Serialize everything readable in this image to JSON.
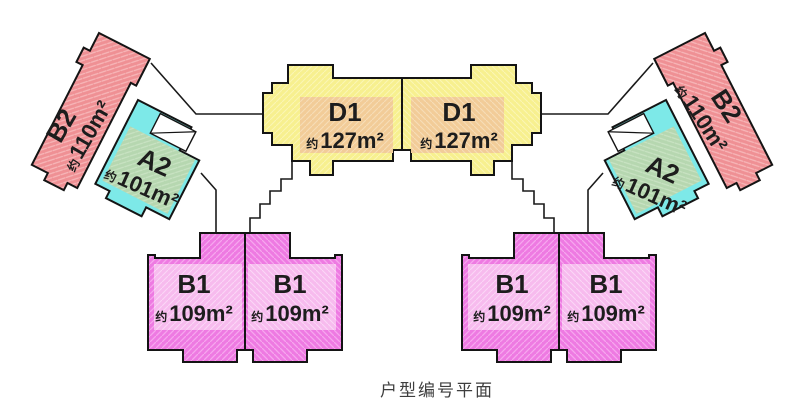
{
  "caption": "户型编号平面",
  "area_prefix": "约",
  "unit_types": {
    "b2": {
      "label": "B2",
      "area": "110m²"
    },
    "a2": {
      "label": "A2",
      "area": "101m²"
    },
    "d1": {
      "label": "D1",
      "area": "127m²"
    },
    "b1": {
      "label": "B1",
      "area": "109m²"
    }
  },
  "instances": [
    {
      "type": "b2",
      "side": "left"
    },
    {
      "type": "a2",
      "side": "left"
    },
    {
      "type": "d1",
      "side": "left"
    },
    {
      "type": "d1",
      "side": "right"
    },
    {
      "type": "a2",
      "side": "right"
    },
    {
      "type": "b2",
      "side": "right"
    },
    {
      "type": "b1",
      "side": "left"
    },
    {
      "type": "b1",
      "side": "left"
    },
    {
      "type": "b1",
      "side": "right"
    },
    {
      "type": "b1",
      "side": "right"
    }
  ],
  "colors": {
    "outline": "#141414",
    "b2_fill": "#ef9094",
    "b2_hatch": "#f7b7b9",
    "a2_cyan": "#7de9e8",
    "a2_green": "#b6d7b0",
    "a2_green_hatch": "#c9e3c3",
    "d1_yellow": "#f7f08f",
    "d1_yellow_hatch": "#fbf6b4",
    "d1_orange": "#f2cc98",
    "d1_orange_hatch": "#f7ddb7",
    "b1_fill": "#ee7ae2",
    "b1_hatch": "#f6a7ee",
    "b1_band": "#f7bbee",
    "b1_band_hatch": "#fbd7f6",
    "text": "#1d1d1d",
    "caption_text": "#3e3e3e",
    "background": "#ffffff"
  }
}
